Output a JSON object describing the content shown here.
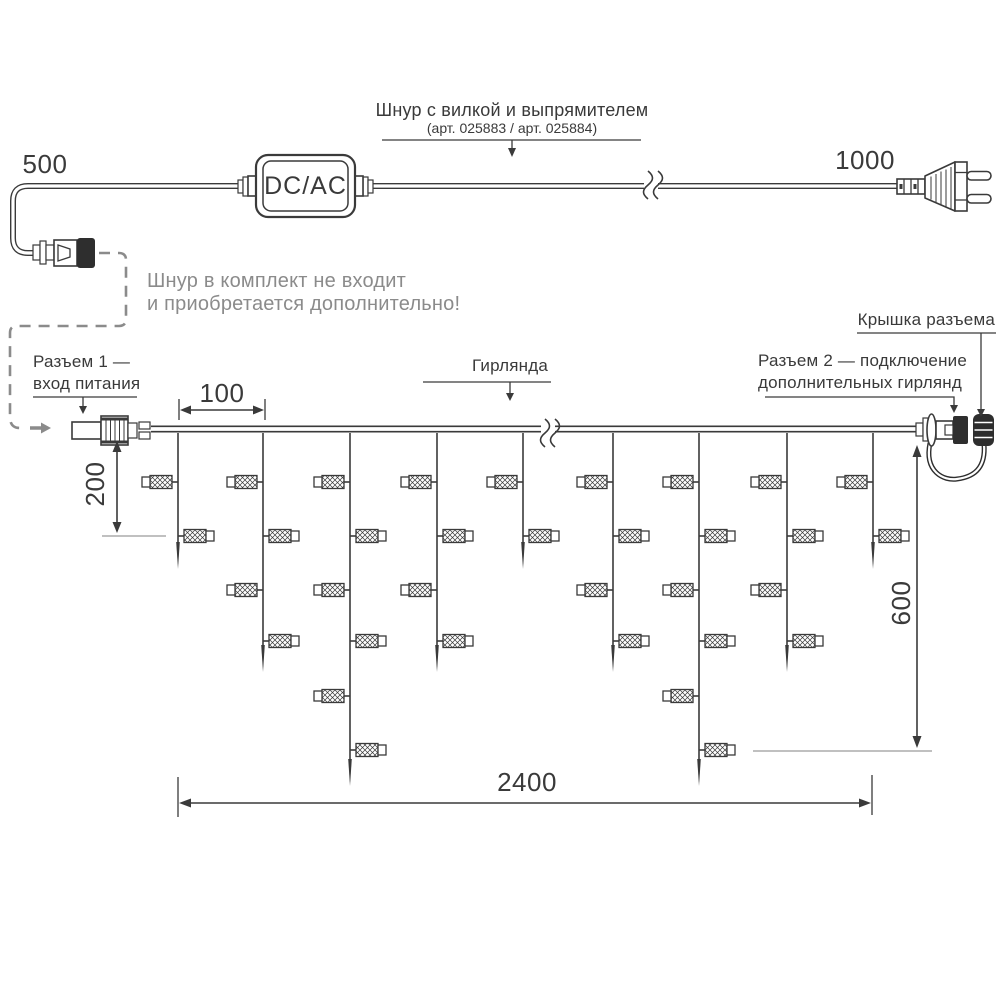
{
  "colors": {
    "ink": "#3a3a3a",
    "gray": "#8b8b8b"
  },
  "power_cord": {
    "dim_left": "500",
    "dim_right": "1000",
    "adapter": "DC/AC",
    "label": "Шнур с вилкой и выпрямителем",
    "label_art": "(арт. 025883 / арт. 025884)",
    "note_line1": "Шнур в комплект не входит",
    "note_line2": "и приобретается дополнительно!"
  },
  "garland": {
    "label": "Гирлянда",
    "connector1_line1": "Разъем 1 —",
    "connector1_line2": "вход питания",
    "connector2_line1": "Разъем 2 — подключение",
    "connector2_line2": "дополнительных гирлянд",
    "cap_label": "Крышка разъема",
    "dim_spacing": "100",
    "dim_first_drop": "200",
    "dim_height": "600",
    "dim_length": "2400",
    "drops_bulb_counts": [
      2,
      4,
      6,
      4,
      2,
      4,
      6,
      4,
      2
    ]
  }
}
